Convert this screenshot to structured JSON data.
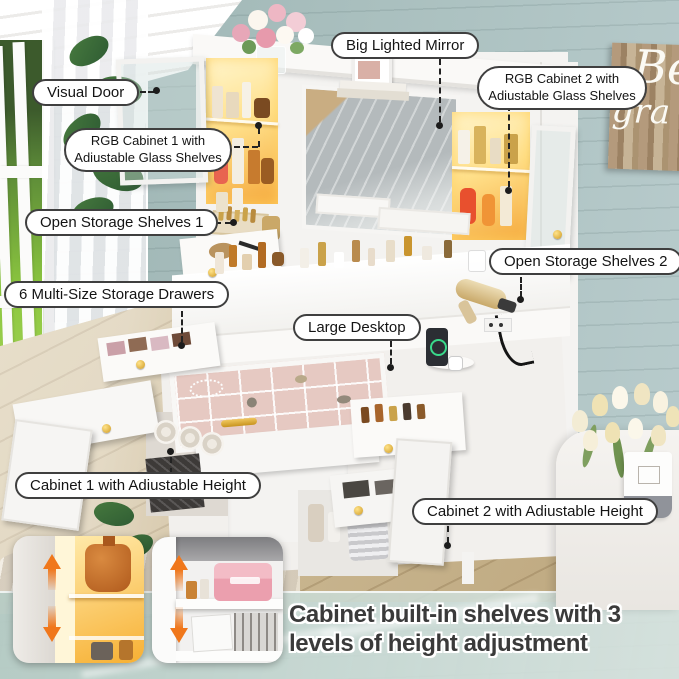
{
  "callouts": [
    {
      "id": "visual-door",
      "label": "Visual Door"
    },
    {
      "id": "rgb-cabinet-1",
      "label": "RGB Cabinet 1 with Adiustable Glass Shelves"
    },
    {
      "id": "big-lighted-mirror",
      "label": "Big Lighted Mirror"
    },
    {
      "id": "rgb-cabinet-2",
      "label": "RGB Cabinet 2 with Adiustable Glass Shelves"
    },
    {
      "id": "open-storage-shelves-1",
      "label": "Open Storage Shelves 1"
    },
    {
      "id": "open-storage-shelves-2",
      "label": "Open Storage Shelves 2"
    },
    {
      "id": "six-multi-size-storage-drawers",
      "label": "6 Multi-Size Storage Drawers"
    },
    {
      "id": "large-desktop",
      "label": "Large Desktop"
    },
    {
      "id": "cabinet-1-adjustable-height",
      "label": "Cabinet 1 with Adiustable Height"
    },
    {
      "id": "cabinet-2-adjustable-height",
      "label": "Cabinet 2 with Adiustable Height"
    }
  ],
  "caption": {
    "text": "Cabinet built-in shelves with 3 levels of height adjustment"
  },
  "wall_sign": {
    "line1": "Be",
    "line2": "gra"
  },
  "colors": {
    "accent_arrow": "#f0771b",
    "led_glow": "#ffd978",
    "knob_gold": "#cf9a22",
    "wall_teal": "#a7bcba",
    "bubble_border": "#3f3f3f",
    "caption_text": "#3a3a3a"
  }
}
